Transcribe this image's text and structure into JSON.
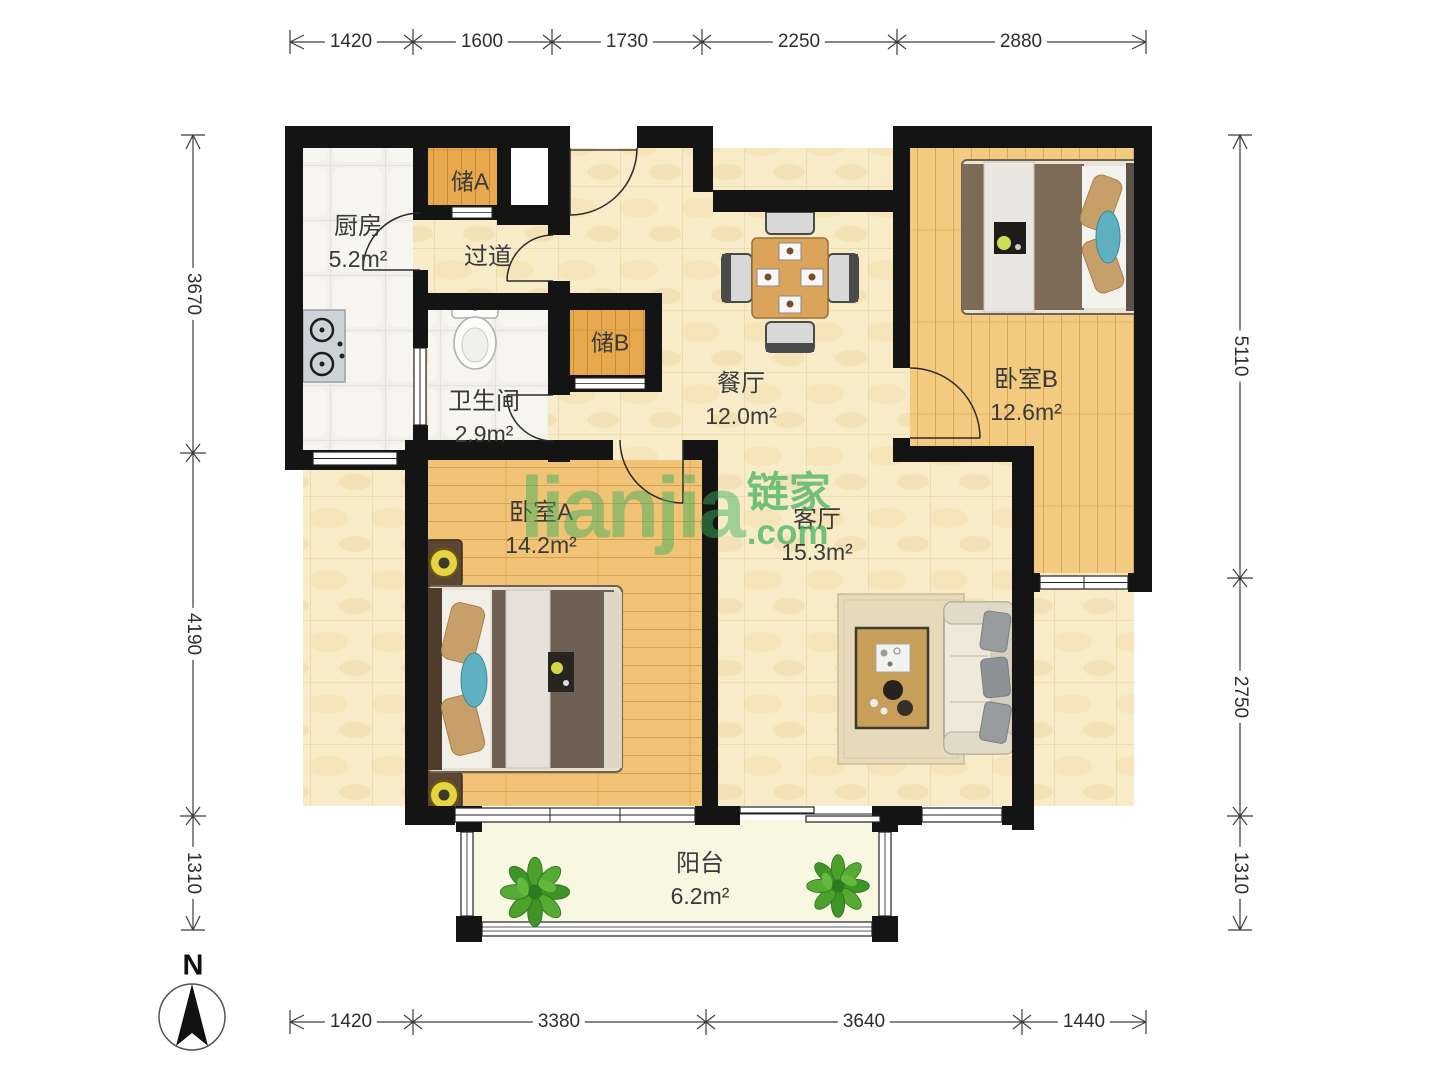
{
  "rooms": {
    "kitchen": {
      "name": "厨房",
      "area": "5.2m²"
    },
    "storage_a": {
      "name": "储A"
    },
    "hallway": {
      "name": "过道"
    },
    "storage_b": {
      "name": "储B"
    },
    "bathroom": {
      "name": "卫生间",
      "area": "2.9m²"
    },
    "dining": {
      "name": "餐厅",
      "area": "12.0m²"
    },
    "bedroom_b": {
      "name": "卧室B",
      "area": "12.6m²"
    },
    "bedroom_a": {
      "name": "卧室A",
      "area": "14.2m²"
    },
    "living": {
      "name": "客厅",
      "area": "15.3m²"
    },
    "balcony": {
      "name": "阳台",
      "area": "6.2m²"
    }
  },
  "dimensions": {
    "top": [
      "1420",
      "1600",
      "1730",
      "2250",
      "2880"
    ],
    "bottom": [
      "1420",
      "3380",
      "3640",
      "1440"
    ],
    "left": [
      "3670",
      "4190",
      "1310"
    ],
    "right": [
      "5110",
      "2750",
      "1310"
    ]
  },
  "compass": {
    "north_label": "N"
  },
  "watermark": {
    "main": "lianjia",
    "zh": "链家",
    "com": ".com"
  },
  "colors": {
    "brand_green": "#3EB05C",
    "wall": "#141414",
    "marble_floor": "#f7ebc8",
    "wood_floor": "#f0c376",
    "tile_floor": "#f1f0ea",
    "balcony_floor": "#f7f7e2"
  }
}
